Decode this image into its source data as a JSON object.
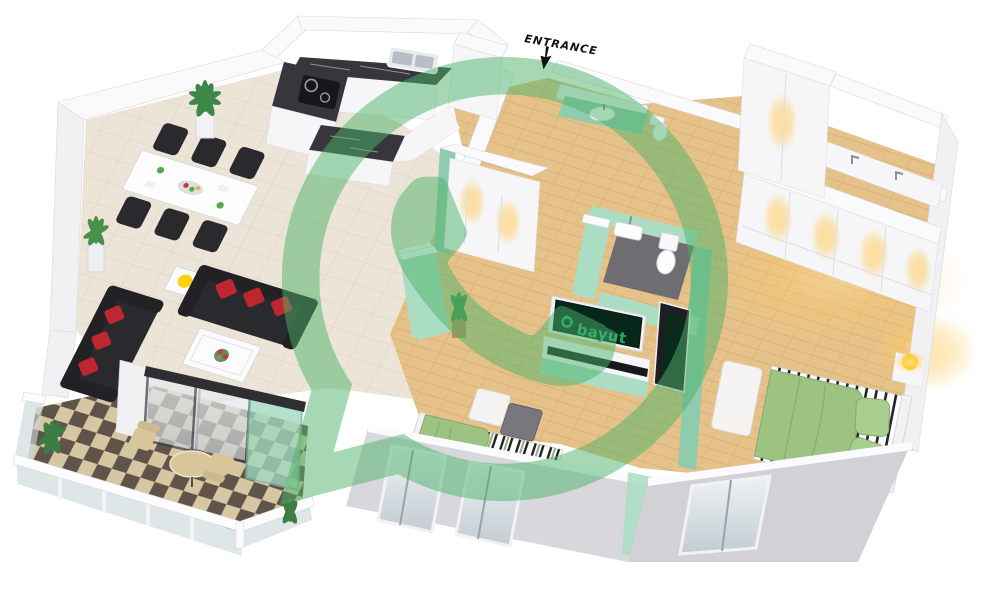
{
  "labels": {
    "entrance": "ENTRANCE",
    "tv_brand": "bayut"
  },
  "icons": {
    "watermark": "whatsapp-logo",
    "entrance_arrow": "down-arrow",
    "tv_logo": "bayut-house-logo"
  },
  "colors": {
    "background": "#ffffff",
    "wall_front": "#d8d8dc",
    "mint": "#aaddc3",
    "mint_dark": "#8fcbad",
    "wood": "#e6c28b",
    "wood_line": "#d2a362",
    "tile": "#ece4d6",
    "tile_line": "#ded5c2",
    "checker_dark": "#60544a",
    "checker_light": "#d6c6a2",
    "marble": "#36363c",
    "sofa_black": "#2a292e",
    "cushion_red": "#bf2730",
    "bed_green": "#9dc383",
    "glass": "#ccd6da",
    "lamp_yellow": "#ffd20a",
    "plant_green": "#3c8748",
    "bayut_screen": "#07271a",
    "bayut_green": "#25ad68",
    "entrance_text": "#111111",
    "watermark": "#4cb268"
  }
}
